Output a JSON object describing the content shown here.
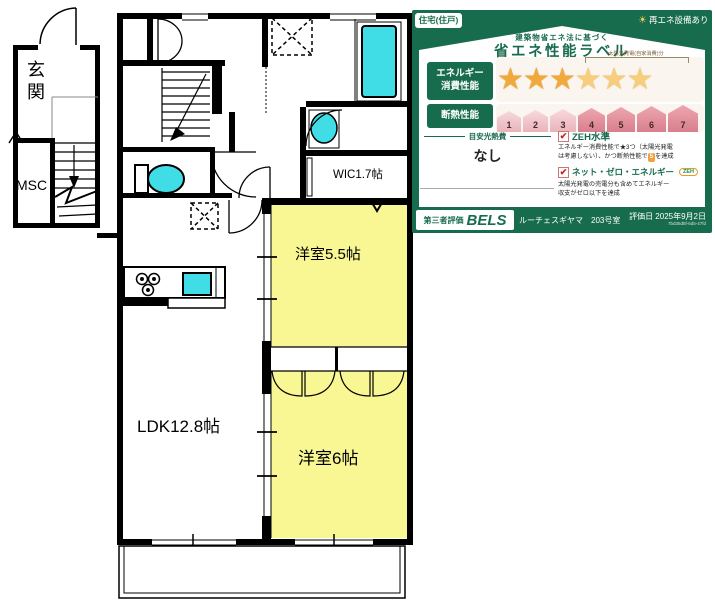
{
  "floor_plan": {
    "rooms": {
      "genkan": "玄関",
      "msc": "MSC",
      "wic": "WIC1.7帖",
      "bedroom1": "洋室5.5帖",
      "ldk": "LDK12.8帖",
      "bedroom2": "洋室6帖"
    },
    "colors": {
      "room_yellow": "#f8f794",
      "fixture_cyan": "#40dde6",
      "wall_black": "#000000"
    }
  },
  "energy_label": {
    "type_badge": "住宅(住戸)",
    "renewable_badge": "再エネ設備あり",
    "sun_glyph": "☀",
    "title_small": "建築物省エネ法に基づく",
    "title_large": "省エネ性能ラベル",
    "star_glyph": "★",
    "check_glyph": "✔",
    "energy": {
      "label_line1": "エネルギー",
      "label_line2": "消費性能",
      "stars_filled": 3,
      "stars_solar": 3,
      "solar_bracket_label": "太陽光発電(自家消費)分"
    },
    "insulation": {
      "label": "断熱性能",
      "levels": [
        "1",
        "2",
        "3",
        "4",
        "5",
        "6",
        "7"
      ]
    },
    "cost": {
      "label": "目安光熱費",
      "value": "なし"
    },
    "zeh": {
      "item1_title": "ZEH水準",
      "item1_desc_line1": "エネルギー消費性能で★3つ（太陽光発電",
      "item1_desc_line2a": "は考慮しない）、かつ断熱性能で",
      "item1_badge": "5",
      "item1_desc_line2b": "を達成",
      "item2_title": "ネット・ゼロ・エネルギー",
      "item2_badge": "ZEH",
      "item2_desc_line1": "太陽光発電の売電分も含めてエネルギー",
      "item2_desc_line2": "収支がゼロ以下を達成"
    },
    "footer": {
      "third_party": "第三者評価",
      "brand": "BELS",
      "building": "ルーチェスギヤマ　203号室",
      "eval_date": "評価日 2025年9月2日",
      "code": "7bd35d5f-6d5-47fd"
    },
    "colors": {
      "green": "#186c4e",
      "star_gold": "#f2a93b",
      "shield_pink": "#d87f8d"
    }
  }
}
